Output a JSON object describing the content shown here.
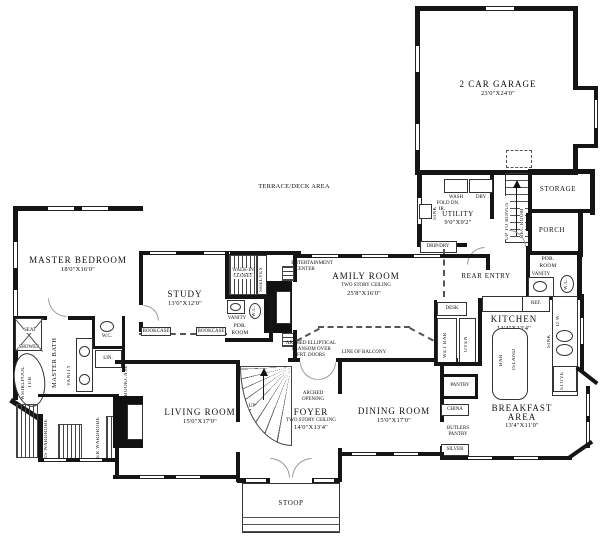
{
  "plan": {
    "rooms": {
      "master_bedroom": {
        "name": "MASTER BEDROOM",
        "dims": "18'0\"X16'0\""
      },
      "study": {
        "name": "STUDY",
        "dims": "13'0\"X12'0\""
      },
      "family_room": {
        "name": "AMILY ROOM",
        "note": "TWO STORY CEILING",
        "dims": "25'8\"X16'0\""
      },
      "garage": {
        "name": "2 CAR GARAGE",
        "dims": "23'0\"X24'0\""
      },
      "utility": {
        "name": "UTILITY",
        "dims": "9'0\"X9'2\""
      },
      "storage": {
        "name": "STORAGE"
      },
      "porch": {
        "name": "PORCH"
      },
      "rear_entry": {
        "name": "REAR ENTRY"
      },
      "kitchen": {
        "name": "KITCHEN",
        "dims": "13'4\"X13'4\""
      },
      "breakfast": {
        "line1": "BREAKFAST",
        "line2": "AREA",
        "dims": "13'4\"X11'0\""
      },
      "dining": {
        "name": "DINING ROOM",
        "dims": "15'0\"X17'0\""
      },
      "foyer": {
        "name": "FOYER",
        "note": "TWO STORY CEILING",
        "dims": "14'0\"X13'4\""
      },
      "living": {
        "name": "LIVING ROOM",
        "dims": "15'0\"X17'0\""
      },
      "master_bath": {
        "name": "MASTER BATH"
      },
      "walk_in_closet": {
        "line1": "WALK-IN",
        "line2": "CLOSET"
      },
      "pdr_mid": {
        "line1": "PDR.",
        "line2": "ROOM"
      },
      "pdr_right": {
        "line1": "PDR.",
        "line2": "ROOM"
      },
      "terrace": {
        "name": "TERRACE/DECK AREA"
      },
      "stoop": {
        "name": "STOOP"
      }
    },
    "labels": {
      "his_wardrobe": "HIS WARDROBE",
      "her_wardrobe": "HER WARDROBE",
      "bookcase": "BOOKCASE",
      "vanity": "VANITY",
      "wc": "W.C.",
      "lin": "LIN.",
      "seat": "SEAT",
      "shower": "SHOWER",
      "whirlpool": "WHIRLPOOL",
      "tub": "TUB",
      "wash": "WASH",
      "dry": "DRY",
      "fold_dn": "FOLD DN.",
      "ir": "IR.",
      "sink": "SINK",
      "drip_dry": "DRIP/DRY",
      "desk": "DESK",
      "wet_bar": "WET BAR",
      "oven": "OVEN",
      "ref": "REF.",
      "bar": "BAR",
      "island": "ISLAND",
      "dw": "D.W.",
      "stove": "STOVE",
      "pantry": "PANTRY",
      "china": "CHINA",
      "butlers": "BUTLERS",
      "silver": "SILVER",
      "up_to_bonus": "UP TO BONUS",
      "rec_room": "REC ROOM",
      "up": "UP",
      "shelves": "SHELVES",
      "entertainment": "ENTERTAINMENT",
      "center": "CENTER",
      "line_of_balcony": "LINE OF BALCONY",
      "arched_elliptical": "ARCHED ELLIPTICAL",
      "transom_over": "TRANSOM OVER",
      "frt_doors": "FRT. DOORS",
      "arched": "ARCHED",
      "opening": "OPENING"
    }
  }
}
